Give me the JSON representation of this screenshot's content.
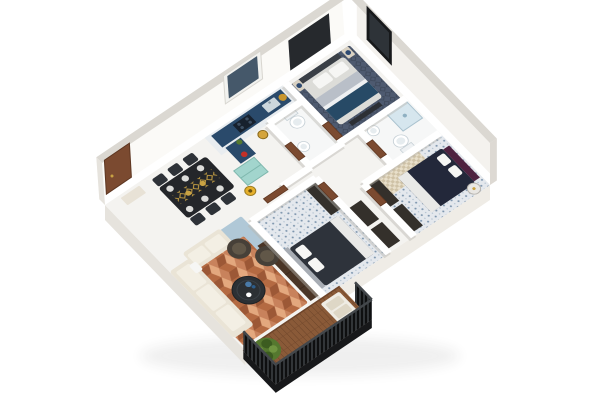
{
  "scene": {
    "type": "3d-floor-plan",
    "view": "isometric-cutaway",
    "style": "photoreal-render",
    "background": "#ffffff"
  },
  "colors": {
    "wallFace": "#fbfaf7",
    "wallFaceSide": "#f4f2ee",
    "wallTop": "#dbd8d2",
    "slabLeft": "#e6e3dd",
    "slabRight": "#efece6",
    "slabCapWest": "#e6e3dd",
    "slabCapEast": "#ddd9d3",
    "floorBase": "#f4f3f0",
    "kitchenFloor": "#e9edf0",
    "bathFloor": "#f6f7f7",
    "tileBase": "#e4e8ed",
    "masterCarpet": "#4e5a70",
    "rugTerracotta": "#c8825c",
    "rugBlue": "#a9c3d4",
    "sofaCream": "#eae4d6",
    "sofaCushion": "#f3efe4",
    "armchair": "#474038",
    "armchairCushion": "#615748",
    "coffeeTable": "#2c3034",
    "diningTable": "#24262a",
    "diningChair": "#2e3238",
    "runnerGold": "#c9a243",
    "counterNavy": "#2a4a6b",
    "cooktop": "#17212e",
    "tealCabinet": "#a2d5cd",
    "pendantGold": "#d4a43c",
    "kettleRed": "#c23028",
    "bowlGold": "#c9962e",
    "woodDoor": "#7b4a30",
    "bed1Mattress": "#dcdcd8",
    "bed1Stripe": "#b9bfc8",
    "bed1Throw": "#274a66",
    "bed1Headboard": "#3a3f46",
    "accentWall": "#26292d",
    "bed2Mattress": "#23283a",
    "bed2Headboard": "#4e2240",
    "bed3Mattress": "#2e333b",
    "bed3Headboard": "#a8adb4",
    "pillowWhite": "#f6f6f4",
    "throwWhite": "#e9e9e7",
    "wardrobe": "#34302b",
    "tvConsole": "#4a3526",
    "nightstand": "#d9d1c2",
    "lampBlue": "#2e4a72",
    "fixtureWhite": "#ffffff",
    "fixtureStroke": "#c6d0d6",
    "showerGlass": "#cfe3ed",
    "deckWood": "#8a5a38",
    "railing": "#35393c",
    "railingDark": "#17181a",
    "bench": "#efece4",
    "benchCushion": "#ded7c6",
    "bush": "#55782f",
    "bushDark": "#3c5c20",
    "bushLight": "#6f9440",
    "windowFrameDark": "#17191b",
    "windowGlass": "#2e3338",
    "windowFrameWhite": "#f2f2ef",
    "windowGlassBlue": "#45586a",
    "floorLampGold": "#e6b02c",
    "checkRugLight": "#e8dfca",
    "checkRugDark": "#cfc2a6",
    "entryConsole": "#e8e2d6",
    "sideTableGlass": "#e9e7e3"
  },
  "rooms": [
    {
      "name": "Master Bedroom",
      "items": [
        "double-bed",
        "headboard",
        "pillows",
        "navy-throw",
        "foot-bench",
        "nightstand",
        "nightstand",
        "table-lamp",
        "table-lamp",
        "patterned-carpet",
        "accent-wall-panel",
        "tall-window"
      ]
    },
    {
      "name": "En-suite Bathroom",
      "items": [
        "shower-enclosure",
        "toilet",
        "pedestal-sink"
      ]
    },
    {
      "name": "Bathroom",
      "items": [
        "toilet",
        "pedestal-sink"
      ]
    },
    {
      "name": "Bedroom 2",
      "items": [
        "double-bed",
        "plum-headboard",
        "pillows",
        "checkered-rug",
        "wardrobe",
        "wardrobe",
        "glass-side-table",
        "mosaic-tile-floor"
      ]
    },
    {
      "name": "Bedroom 3",
      "items": [
        "double-bed",
        "gray-headboard",
        "pillows",
        "dresser",
        "hallway-wardrobes",
        "mosaic-tile-floor"
      ]
    },
    {
      "name": "Kitchen",
      "items": [
        "l-shaped-navy-counter",
        "kitchen-sink",
        "cooktop",
        "island",
        "teal-fridge-cabinet",
        "gold-pendant-light",
        "fruit-bowl",
        "red-kettle",
        "plant",
        "window"
      ]
    },
    {
      "name": "Dining Area",
      "items": [
        "black-dining-table",
        "gold-patterned-runner",
        "six-chairs",
        "plates",
        "floor-lamp"
      ]
    },
    {
      "name": "Living Room",
      "items": [
        "corner-sofa",
        "seat-cushions",
        "armchair",
        "armchair",
        "round-coffee-table",
        "terracotta-cube-rug",
        "blue-area-rug",
        "tv-console"
      ]
    },
    {
      "name": "Entry",
      "items": [
        "entry-door",
        "console-table"
      ]
    },
    {
      "name": "Balcony",
      "items": [
        "wood-deck",
        "slat-railing",
        "outdoor-bench",
        "bench-cushions",
        "shrub"
      ]
    }
  ]
}
